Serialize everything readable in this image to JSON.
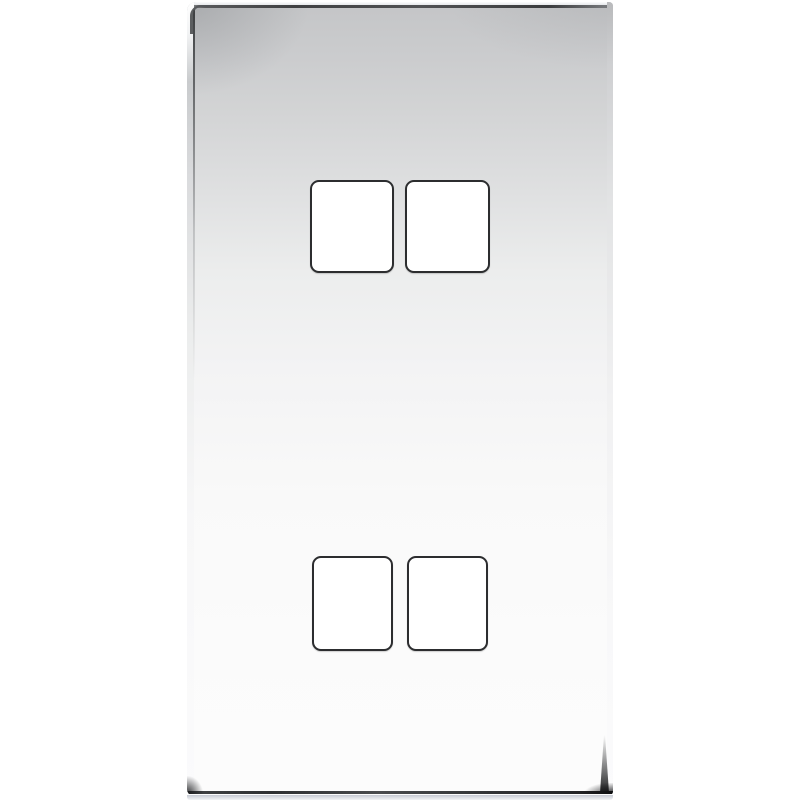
{
  "scene": {
    "type": "product-photo",
    "subject": "polished-chrome-switch-faceplate",
    "aperture_count": 4,
    "apertures": [
      {
        "id": "top-left"
      },
      {
        "id": "top-right"
      },
      {
        "id": "bottom-left"
      },
      {
        "id": "bottom-right"
      }
    ]
  },
  "colors": {
    "background": "#ffffff",
    "plate_top": "#c4c5c7",
    "plate_mid": "#eceded",
    "plate_bottom": "#fcfcfc",
    "edge_dark": "#3f4042",
    "edge_highlight": "#ffffff",
    "aperture_border": "#2c2d2f",
    "aperture_fill": "#ffffff",
    "ground_reflection": "#ccd2dc"
  }
}
